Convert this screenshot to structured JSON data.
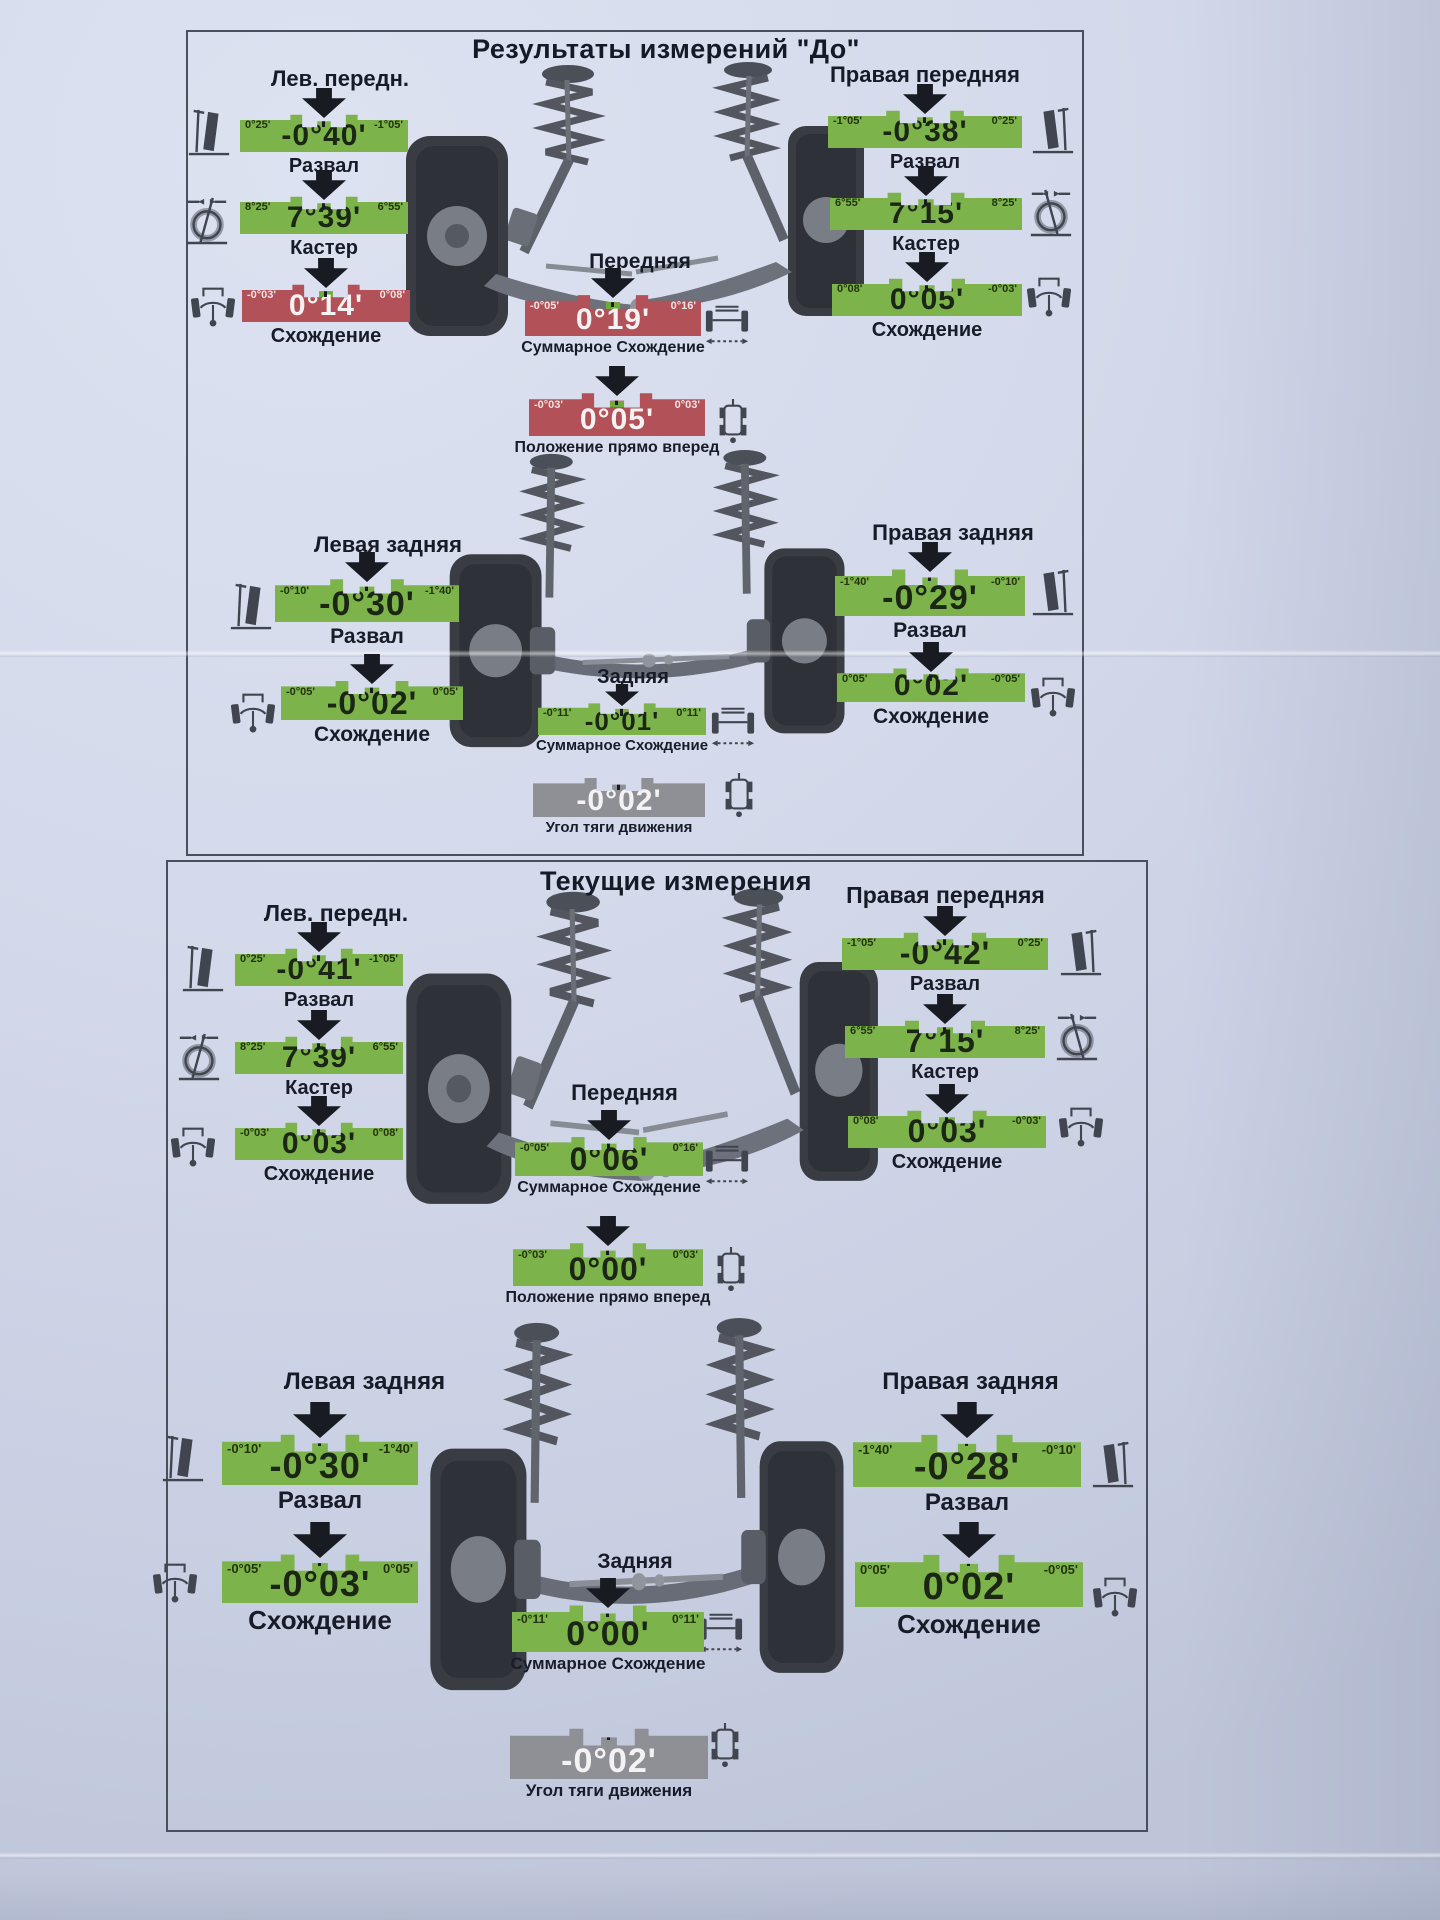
{
  "report": {
    "sections": [
      {
        "title": "Результаты измерений \"До\"",
        "front": {
          "left_label": "Лев. передн.",
          "right_label": "Правая передняя",
          "axle_label": "Передняя",
          "left": {
            "camber": {
              "limit_left": "0°25'",
              "limit_right": "-1°05'",
              "value": "-0°40'",
              "caption": "Развал",
              "status": "ok"
            },
            "caster": {
              "limit_left": "8°25'",
              "limit_right": "6°55'",
              "value": "7°39'",
              "caption": "Кастер",
              "status": "ok"
            },
            "toe": {
              "limit_left": "-0°03'",
              "limit_right": "0°08'",
              "value": "0°14'",
              "caption": "Схождение",
              "status": "out"
            }
          },
          "right": {
            "camber": {
              "limit_left": "-1°05'",
              "limit_right": "0°25'",
              "value": "-0°38'",
              "caption": "Развал",
              "status": "ok"
            },
            "caster": {
              "limit_left": "6°55'",
              "limit_right": "8°25'",
              "value": "7°15'",
              "caption": "Кастер",
              "status": "ok"
            },
            "toe": {
              "limit_left": "0°08'",
              "limit_right": "-0°03'",
              "value": "0°05'",
              "caption": "Схождение",
              "status": "ok"
            }
          },
          "total_toe": {
            "limit_left": "-0°05'",
            "limit_right": "0°16'",
            "value": "0°19'",
            "caption": "Суммарное Схождение",
            "status": "out"
          },
          "straight_ahead": {
            "limit_left": "-0°03'",
            "limit_right": "0°03'",
            "value": "0°05'",
            "caption": "Положение прямо вперед",
            "status": "out"
          }
        },
        "rear": {
          "left_label": "Левая задняя",
          "right_label": "Правая задняя",
          "axle_label": "Задняя",
          "left": {
            "camber": {
              "limit_left": "-0°10'",
              "limit_right": "-1°40'",
              "value": "-0°30'",
              "caption": "Развал",
              "status": "ok"
            },
            "toe": {
              "limit_left": "-0°05'",
              "limit_right": "0°05'",
              "value": "-0°02'",
              "caption": "Схождение",
              "status": "ok"
            }
          },
          "right": {
            "camber": {
              "limit_left": "-1°40'",
              "limit_right": "-0°10'",
              "value": "-0°29'",
              "caption": "Развал",
              "status": "ok"
            },
            "toe": {
              "limit_left": "0°05'",
              "limit_right": "-0°05'",
              "value": "0°02'",
              "caption": "Схождение",
              "status": "ok"
            }
          },
          "total_toe": {
            "limit_left": "-0°11'",
            "limit_right": "0°11'",
            "value": "-0°01'",
            "caption": "Суммарное Схождение",
            "status": "ok"
          },
          "thrust_angle": {
            "value": "-0°02'",
            "caption": "Угол тяги движения",
            "status": "neutral"
          }
        }
      },
      {
        "title": "Текущие измерения",
        "front": {
          "left_label": "Лев. передн.",
          "right_label": "Правая передняя",
          "axle_label": "Передняя",
          "left": {
            "camber": {
              "limit_left": "0°25'",
              "limit_right": "-1°05'",
              "value": "-0°41'",
              "caption": "Развал",
              "status": "ok"
            },
            "caster": {
              "limit_left": "8°25'",
              "limit_right": "6°55'",
              "value": "7°39'",
              "caption": "Кастер",
              "status": "ok"
            },
            "toe": {
              "limit_left": "-0°03'",
              "limit_right": "0°08'",
              "value": "0°03'",
              "caption": "Схождение",
              "status": "ok"
            }
          },
          "right": {
            "camber": {
              "limit_left": "-1°05'",
              "limit_right": "0°25'",
              "value": "-0°42'",
              "caption": "Развал",
              "status": "ok"
            },
            "caster": {
              "limit_left": "6°55'",
              "limit_right": "8°25'",
              "value": "7°15'",
              "caption": "Кастер",
              "status": "ok"
            },
            "toe": {
              "limit_left": "0°08'",
              "limit_right": "-0°03'",
              "value": "0°03'",
              "caption": "Схождение",
              "status": "ok"
            }
          },
          "total_toe": {
            "limit_left": "-0°05'",
            "limit_right": "0°16'",
            "value": "0°06'",
            "caption": "Суммарное Схождение",
            "status": "ok"
          },
          "straight_ahead": {
            "limit_left": "-0°03'",
            "limit_right": "0°03'",
            "value": "0°00'",
            "caption": "Положение прямо вперед",
            "status": "ok"
          }
        },
        "rear": {
          "left_label": "Левая задняя",
          "right_label": "Правая задняя",
          "axle_label": "Задняя",
          "left": {
            "camber": {
              "limit_left": "-0°10'",
              "limit_right": "-1°40'",
              "value": "-0°30'",
              "caption": "Развал",
              "status": "ok"
            },
            "toe": {
              "limit_left": "-0°05'",
              "limit_right": "0°05'",
              "value": "-0°03'",
              "caption": "Схождение",
              "status": "ok"
            }
          },
          "right": {
            "camber": {
              "limit_left": "-1°40'",
              "limit_right": "-0°10'",
              "value": "-0°28'",
              "caption": "Развал",
              "status": "ok"
            },
            "toe": {
              "limit_left": "0°05'",
              "limit_right": "-0°05'",
              "value": "0°02'",
              "caption": "Схождение",
              "status": "ok"
            }
          },
          "total_toe": {
            "limit_left": "-0°11'",
            "limit_right": "0°11'",
            "value": "0°00'",
            "caption": "Суммарное Схождение",
            "status": "ok"
          },
          "thrust_angle": {
            "value": "-0°02'",
            "caption": "Угол тяги движения",
            "status": "neutral"
          }
        }
      }
    ],
    "status_colors": {
      "ok": "#7cb34b",
      "out": "#b25157",
      "neutral": "#8f9096"
    },
    "icons": {
      "camber": "camber-icon",
      "caster": "caster-icon",
      "toe": "toe-icon",
      "total_toe": "axle-icon",
      "vehicle_top": "vehicle-top-icon",
      "arrow": "arrow-down-icon"
    }
  }
}
